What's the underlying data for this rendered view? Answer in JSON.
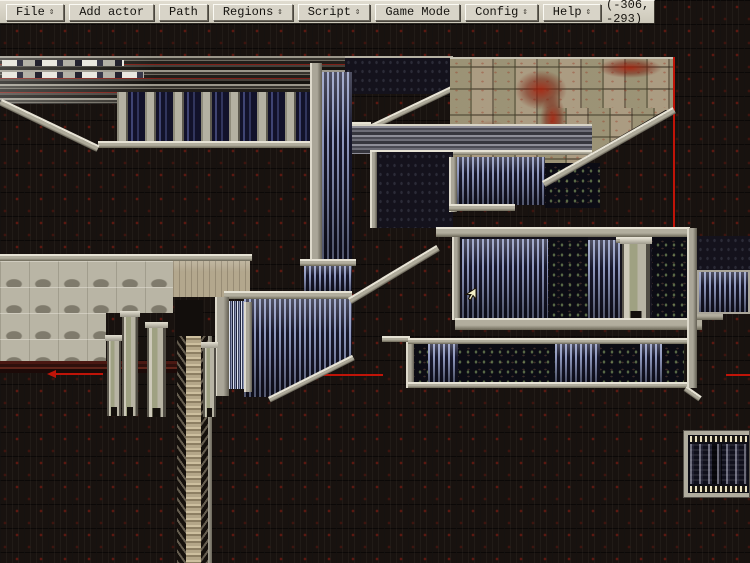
{
  "menubar": {
    "items": [
      {
        "label": "File",
        "has_arrow": true
      },
      {
        "label": "Add actor",
        "has_arrow": false
      },
      {
        "label": "Path",
        "has_arrow": false
      },
      {
        "label": "Regions",
        "has_arrow": true
      },
      {
        "label": "Script",
        "has_arrow": true
      },
      {
        "label": "Game Mode",
        "has_arrow": false
      },
      {
        "label": "Config",
        "has_arrow": true
      },
      {
        "label": "Help",
        "has_arrow": true
      }
    ],
    "arrow_glyph": "⇕",
    "coordinates": "(-306, -293)"
  },
  "map": {
    "cursor": {
      "x": 466,
      "y": 288
    },
    "palette": {
      "background": "#18120f",
      "grid_red": "#6e1812",
      "structure_light": "#b8b4a6",
      "steel_blue": "#8890b2",
      "interior_dark": "#10101c",
      "tan_tiles": "#ab9c82",
      "rust": "#8c2212",
      "region_line_red": "#c01408",
      "ladder_tan": "#c0b294",
      "maroon_band": "#4a1812"
    },
    "structures": [
      "upper-platform-band",
      "pillar-gallery",
      "descending-ramp",
      "tan-tile-building",
      "mid-gray-platform",
      "central-shaft",
      "machine-room",
      "lower-machine-room",
      "scalloped-block",
      "pillar-cluster",
      "ladder-shaft",
      "side-panel",
      "signal-panel"
    ]
  }
}
